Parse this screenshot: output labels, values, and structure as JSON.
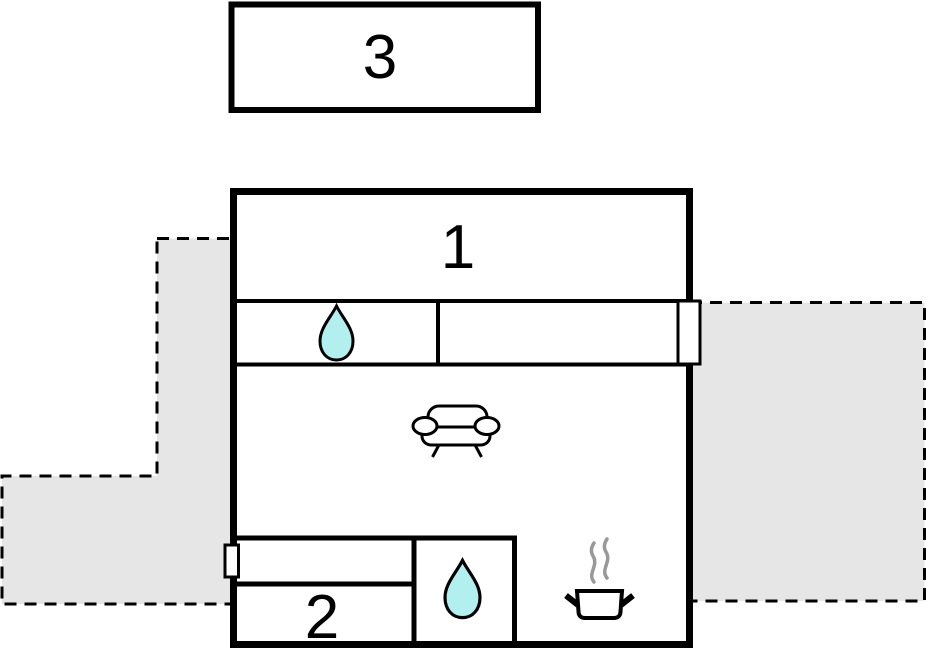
{
  "floorplan": {
    "rooms": [
      {
        "id": "room-1",
        "label": "1"
      },
      {
        "id": "room-2",
        "label": "2"
      },
      {
        "id": "annex",
        "label": "3"
      }
    ],
    "icons": {
      "hall_fixture": "water-drop-icon",
      "bathroom_fixture": "water-drop-icon",
      "living_area": "sofa-icon",
      "kitchen": "cooking-pot-icon"
    },
    "colors": {
      "outline": "#000000",
      "terrace_fill": "#e6e6e6",
      "water_drop_fill": "#b2f0f0",
      "steam": "#999999",
      "background": "#ffffff"
    }
  }
}
